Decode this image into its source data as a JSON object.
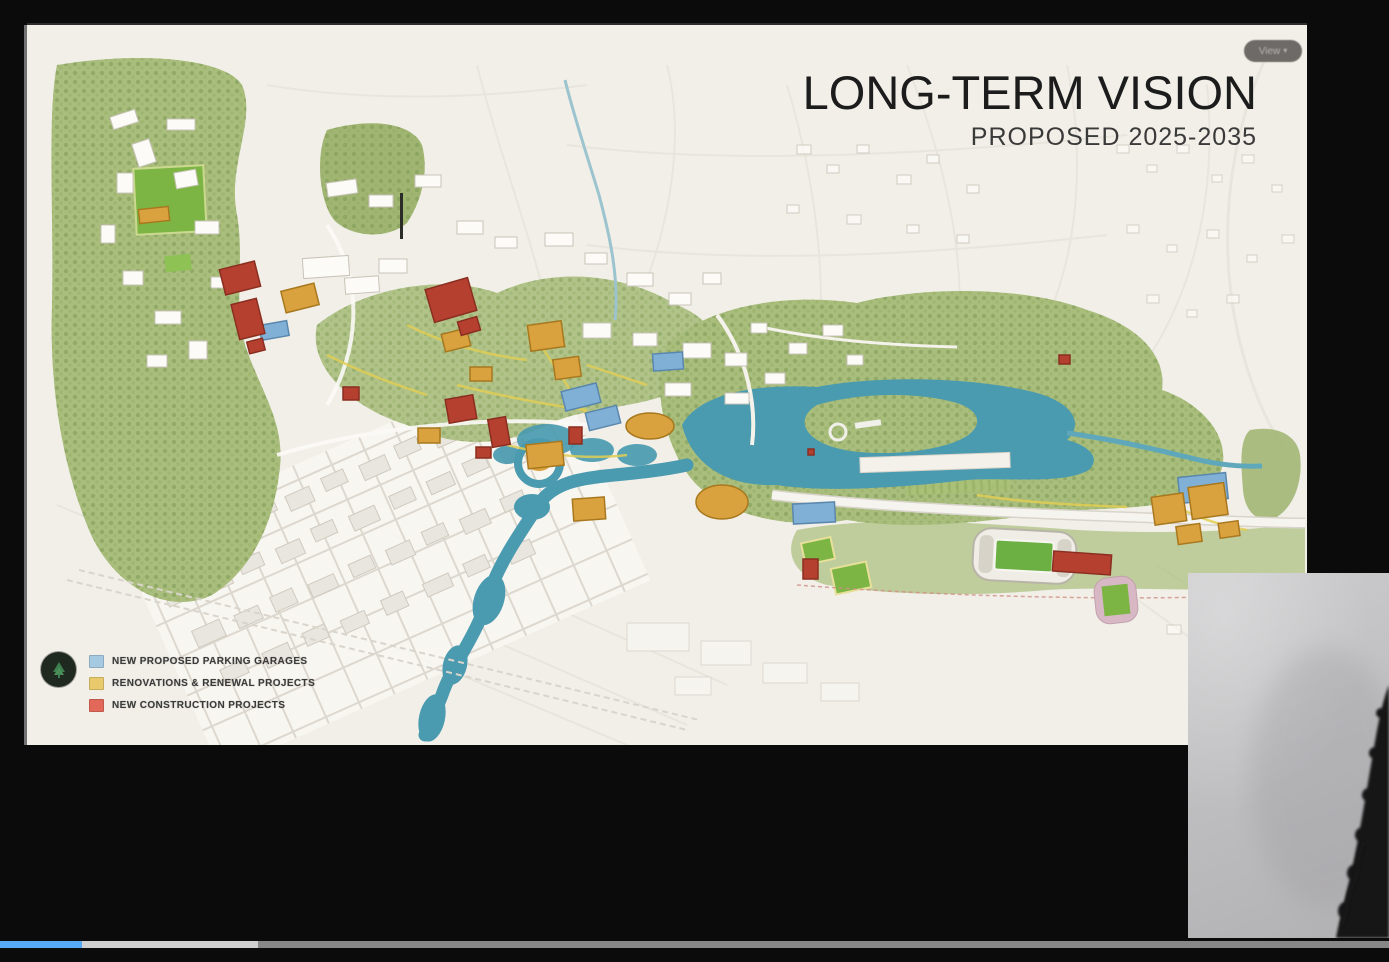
{
  "frame": {
    "background_color": "#0b0b0b"
  },
  "slide": {
    "background_color": "#f2f0ea",
    "title": "LONG-TERM VISION",
    "subtitle": "PROPOSED 2025-2035",
    "view_badge": {
      "label": "View",
      "caret": "▾"
    },
    "legend": {
      "items": [
        {
          "label": "NEW PROPOSED PARKING GARAGES",
          "color": "#a6c9e2"
        },
        {
          "label": "RENOVATIONS & RENEWAL PROJECTS",
          "color": "#e8c96c"
        },
        {
          "label": "NEW CONSTRUCTION PROJECTS",
          "color": "#e2685a"
        }
      ]
    },
    "map": {
      "kind": "illustrated aerial campus master plan",
      "palette": {
        "water": "#4a9ab0",
        "parkland": "#a9bd7c",
        "athletic_field": "#7cb544",
        "new_construction": "#b5402f",
        "renovation_renewal": "#d9a23e",
        "parking_garage": "#81b0d6",
        "existing_building": "#fcfbf7",
        "ground": "#f2f0ea"
      },
      "features": [
        "winding river flowing to bottom edge",
        "lake with wooded island",
        "forested parkland",
        "football stadium with green pitch",
        "practice fields",
        "downtown street grid",
        "campus building clusters",
        "highway along south side"
      ]
    }
  },
  "webcam": {
    "wall_color": "#c6c5c7",
    "content": "person silhouette at right edge"
  },
  "player": {
    "segments": [
      {
        "name": "played",
        "color": "#55a9f7",
        "width_px": 82
      },
      {
        "name": "buffered",
        "color": "#cfcfcf",
        "width_px": 176
      },
      {
        "name": "remaining",
        "color": "#878787",
        "width_px": 1131
      }
    ]
  }
}
